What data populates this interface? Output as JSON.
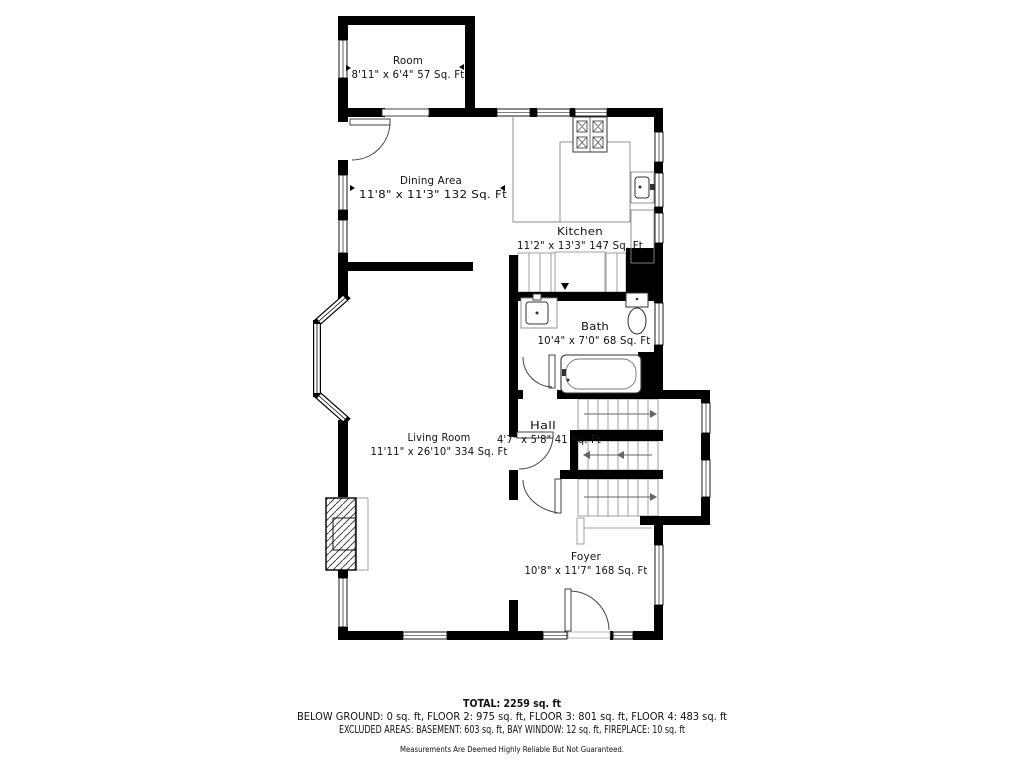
{
  "colors": {
    "wall": "#000000",
    "fixture": "#333333",
    "counter": "#888888",
    "stair_line": "#8a8a8a",
    "text": "#111111",
    "disclaimer": "#4a4a4a",
    "background": "#ffffff"
  },
  "rooms": [
    {
      "name": "Room",
      "dims": "8'11\" x 6'4\" 57 Sq. Ft"
    },
    {
      "name": "Dining Area",
      "dims": "11'8\" x 11'3\" 132 Sq. Ft"
    },
    {
      "name": "Kitchen",
      "dims": "11'2\" x 13'3\" 147 Sq. Ft"
    },
    {
      "name": "Bath",
      "dims": "10'4\" x 7'0\" 68 Sq. Ft"
    },
    {
      "name": "Hall",
      "dims": "4'7\" x 5'8\" 41 Sq. Ft"
    },
    {
      "name": "Living Room",
      "dims": "11'11\" x 26'10\" 334 Sq. Ft"
    },
    {
      "name": "Foyer",
      "dims": "10'8\" x 11'7\" 168 Sq. Ft"
    }
  ],
  "summary": {
    "total": "TOTAL: 2259 sq. ft",
    "floors": "BELOW GROUND: 0 sq. ft, FLOOR 2: 975 sq. ft, FLOOR 3: 801 sq. ft, FLOOR 4: 483 sq. ft",
    "excluded": "EXCLUDED AREAS: BASEMENT: 603 sq. ft, BAY WINDOW: 12 sq. ft, FIREPLACE: 10 sq. ft",
    "disclaimer": "Measurements Are Deemed Highly Reliable But Not Guaranteed."
  }
}
